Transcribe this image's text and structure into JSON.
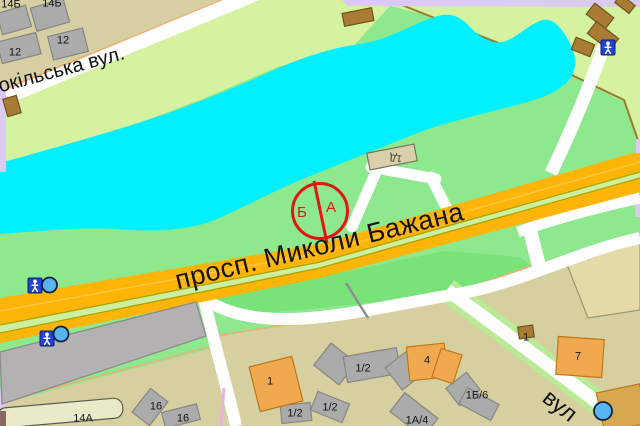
{
  "map": {
    "type": "city-map-viewer",
    "streets": {
      "sokilska": "окільська вул.",
      "avenue": "просп. Миколи Бажана",
      "vul": "вул"
    },
    "marker": {
      "point_b": "Б",
      "point_a": "А",
      "description": "route points A/B inside red circle with divider line"
    },
    "buildings": [
      {
        "label": "14Б"
      },
      {
        "label": "14Б"
      },
      {
        "label": "12"
      },
      {
        "label": "12"
      },
      {
        "label": "1Д"
      },
      {
        "label": "14А"
      },
      {
        "label": "16"
      },
      {
        "label": "16"
      },
      {
        "label": "1"
      },
      {
        "label": "1/2"
      },
      {
        "label": "1/2"
      },
      {
        "label": "1/2"
      },
      {
        "label": "4"
      },
      {
        "label": "1А/4"
      },
      {
        "label": "1Б/6"
      },
      {
        "label": "1"
      },
      {
        "label": "7"
      }
    ],
    "icons": [
      {
        "name": "pedestrian-crossing-icon"
      },
      {
        "name": "bus-stop-icon"
      },
      {
        "name": "pedestrian-crossing-icon"
      },
      {
        "name": "bus-stop-icon"
      },
      {
        "name": "pedestrian-crossing-icon"
      },
      {
        "name": "bus-stop-icon"
      }
    ],
    "colors": {
      "water": "#00F0FF",
      "park_green": "#8DE88E",
      "dark_green": "#79E279",
      "light_green": "#D4F2A0",
      "avenue_yellow": "#FFB408",
      "residential_tan": "#D6CF9F",
      "khaki_block": "#D5CFA3",
      "marker_red": "#E41414",
      "transit_blue": "#2343D6",
      "bus_stop_fill": "#58B5F2",
      "lavender_border": "#DCCAF2"
    }
  }
}
